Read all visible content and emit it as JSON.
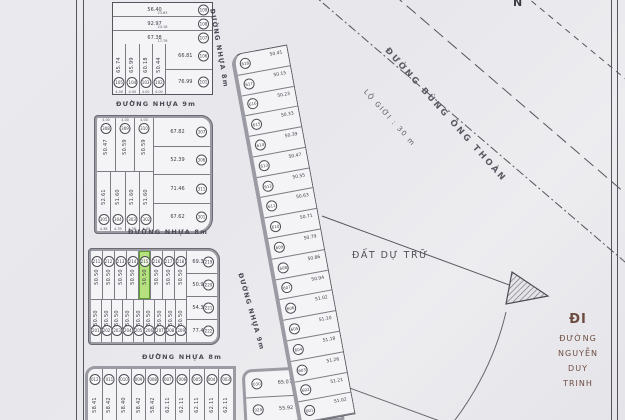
{
  "compass": "N",
  "streets": {
    "top_9m": "ĐƯỜNG NHỰA 9m",
    "top_8m_vertical": "ĐƯỜNG NHỰA 8m",
    "mid_8m": "ĐƯỜNG NHỰA 8m",
    "lower_8m": "ĐƯỜNG NHỰA 8m",
    "mid_9m_vertical": "ĐƯỜNG NHỰA 9m"
  },
  "road": {
    "name": "ĐƯỜNG BÙNG ÔNG THOÀN",
    "boundary_label": "LỘ GIỚI : 30 m"
  },
  "labels": {
    "reserve_land": "ĐẤT DỰ TRỮ",
    "direction_prefix": "ĐI",
    "direction_street": [
      "ĐƯỜNG",
      "NGUYỄN",
      "DUY",
      "TRINH"
    ]
  },
  "blocks": {
    "top_left": {
      "h_plots": [
        {
          "id": "109",
          "area": "56.40",
          "dim": "23.63"
        },
        {
          "id": "108",
          "area": "92.97",
          "dim": "24.16"
        },
        {
          "id": "107",
          "area": "67.38",
          "dim": "17.76"
        }
      ],
      "v_plots": [
        {
          "id": "105",
          "area": "65.74",
          "w": "4.00"
        },
        {
          "id": "104",
          "area": "65.99",
          "w": "4.00"
        },
        {
          "id": "103",
          "area": "60.18",
          "w": "4.00"
        },
        {
          "id": "102",
          "area": "50.44",
          "w": "4.00"
        }
      ],
      "r_plots": [
        {
          "id": "106",
          "area": "66.81"
        },
        {
          "id": "101",
          "area": "76.99"
        }
      ]
    },
    "mid_left": {
      "top_row": [
        {
          "id": "308",
          "area": "50.47",
          "w": "4.00"
        },
        {
          "id": "309",
          "area": "50.59",
          "w": "4.00"
        },
        {
          "id": "310",
          "area": "50.59",
          "w": "4.00"
        }
      ],
      "right_col": [
        {
          "id": "307",
          "area": "67.82"
        },
        {
          "id": "306",
          "area": "52.39"
        },
        {
          "id": "311",
          "area": "71.46"
        },
        {
          "id": "301",
          "area": "67.62"
        }
      ],
      "bottom_row": [
        {
          "id": "305",
          "area": "52.61",
          "w": "4.38"
        },
        {
          "id": "304",
          "area": "51.60",
          "w": "4.39"
        },
        {
          "id": "303",
          "area": "51.60",
          "w": "4.38"
        },
        {
          "id": "302",
          "area": "51.60",
          "w": "4.59"
        }
      ]
    },
    "lower_left": {
      "top_row": [
        {
          "id": "211",
          "area": "50.50"
        },
        {
          "id": "212",
          "area": "50.50"
        },
        {
          "id": "213",
          "area": "50.50"
        },
        {
          "id": "214",
          "area": "50.50"
        },
        {
          "id": "215",
          "area": "50.50",
          "highlight": true
        },
        {
          "id": "216",
          "area": "50.50"
        },
        {
          "id": "217",
          "area": "50.50"
        },
        {
          "id": "218",
          "area": "50.50"
        }
      ],
      "right_col": [
        {
          "id": "219",
          "area": "69.35"
        },
        {
          "id": "220",
          "area": "50.91"
        },
        {
          "id": "221",
          "area": "54.36"
        },
        {
          "id": "222",
          "area": "77.46"
        }
      ],
      "bottom_row": [
        {
          "id": "201",
          "area": "50.50"
        },
        {
          "id": "202",
          "area": "50.50"
        },
        {
          "id": "203",
          "area": "50.50"
        },
        {
          "id": "204",
          "area": "50.50"
        },
        {
          "id": "205",
          "area": "50.50"
        },
        {
          "id": "206",
          "area": "50.50"
        },
        {
          "id": "207",
          "area": "50.50"
        },
        {
          "id": "208",
          "area": "50.50"
        },
        {
          "id": "209",
          "area": "50.50"
        }
      ]
    },
    "bottom_strip": {
      "plots": [
        {
          "id": "012",
          "area": "58.41"
        },
        {
          "id": "011",
          "area": "58.42"
        },
        {
          "id": "010",
          "area": "58.40"
        },
        {
          "id": "009",
          "area": "58.42"
        },
        {
          "id": "008",
          "area": "58.42"
        },
        {
          "id": "007",
          "area": "62.11"
        },
        {
          "id": "006",
          "area": "62.11"
        },
        {
          "id": "005",
          "area": "62.11"
        },
        {
          "id": "004",
          "area": "62.11"
        },
        {
          "id": "003",
          "area": "62.11"
        }
      ]
    },
    "bottom_mid": {
      "plots": [
        {
          "id": "030",
          "area": "65.07"
        },
        {
          "id": "029",
          "area": "55.92"
        }
      ]
    },
    "road_strip": {
      "plots": [
        {
          "id": "618",
          "area": "50.41"
        },
        {
          "id": "617",
          "area": "50.15"
        },
        {
          "id": "616",
          "area": "50.23"
        },
        {
          "id": "615",
          "area": "50.33"
        },
        {
          "id": "614",
          "area": "50.39"
        },
        {
          "id": "613",
          "area": "50.47"
        },
        {
          "id": "612",
          "area": "50.55"
        },
        {
          "id": "611",
          "area": "50.63"
        },
        {
          "id": "610",
          "area": "50.71"
        },
        {
          "id": "609",
          "area": "50.79"
        },
        {
          "id": "608",
          "area": "50.86"
        },
        {
          "id": "607",
          "area": "50.94"
        },
        {
          "id": "606",
          "area": "51.02"
        },
        {
          "id": "605",
          "area": "51.10"
        },
        {
          "id": "604",
          "area": "51.18"
        },
        {
          "id": "603",
          "area": "51.26"
        },
        {
          "id": "602",
          "area": "51.21"
        },
        {
          "id": "601",
          "area": "51.02"
        }
      ]
    }
  },
  "colors": {
    "paper": "#e8e8ec",
    "fill": "#f4f4f6",
    "ln": "#55555e",
    "thick": "#9b9ba3",
    "ink": "#3c3c46",
    "hl": "#b7e07f",
    "hlb": "#5a9e2f",
    "dir": "#6d4c41"
  }
}
